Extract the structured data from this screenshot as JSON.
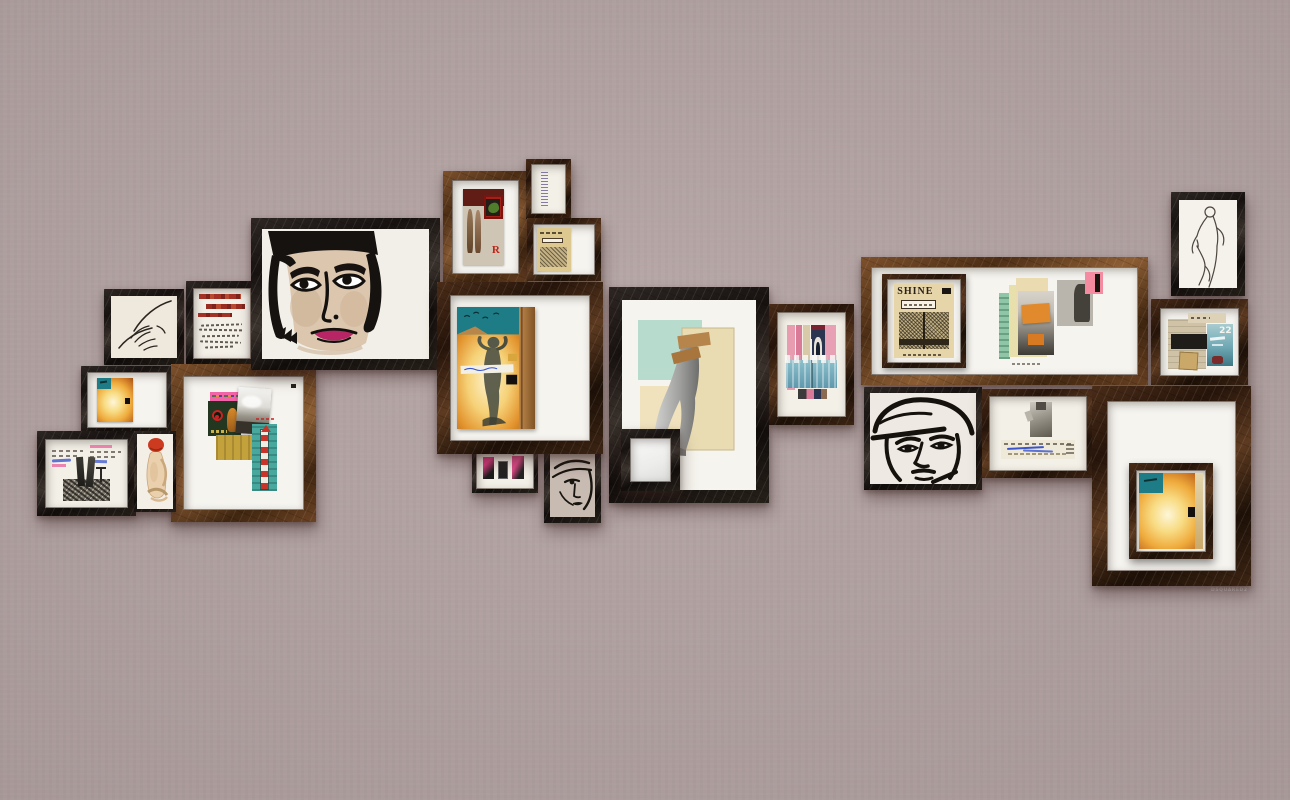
{
  "scene": {
    "type": "gallery-wall-photograph",
    "wall_color": "#b3a2a2",
    "installation": "cluster of vintage framed artworks and collages arranged in a horizontal band"
  },
  "watermark": "DSQUARED2",
  "artwork_texts": {
    "shine_title": "SHINE",
    "number_22": "22",
    "letter_r": "R"
  },
  "palette": {
    "wall": "#b3a2a2",
    "frame_black": "#171210",
    "frame_espresso": "#3c2413",
    "frame_brown": "#6b4223",
    "mat_white": "#f6f4ef",
    "accent_magenta": "#b82565",
    "accent_pink": "#f263a8",
    "accent_teal": "#1d7c85",
    "accent_fire_orange": "#efab3c",
    "accent_mint": "#b7dcce",
    "accent_blue_band": "#7ab4c4"
  },
  "frames": [
    {
      "id": "hand-sketch",
      "description": "ink line drawing of a hand, black distressed frame"
    },
    {
      "id": "red-text-collage",
      "description": "handwriting with red painted strips, black frame"
    },
    {
      "id": "woman-face-portrait",
      "description": "large ink and wash portrait of a woman with black bob and magenta lips"
    },
    {
      "id": "two-figures-collage",
      "description": "sepia collage with two nude figures, pepper picture and red letter R"
    },
    {
      "id": "vertical-card",
      "description": "small card with vertical handwriting strip"
    },
    {
      "id": "mini-sheet-music",
      "description": "small yellowed sheet-music cover collage"
    },
    {
      "id": "fire-paper-small",
      "description": "burned orange paper collage with teal corner on white mat"
    },
    {
      "id": "left-brown-collage",
      "description": "large mixed collage: pink strip, green panel, clouds photo, mustard patch, striped rocket on teal"
    },
    {
      "id": "legs-text-collage",
      "description": "black and white legs photo collage with annotated text snippets"
    },
    {
      "id": "red-hair-figure",
      "description": "watercolor seated nude with red hair"
    },
    {
      "id": "standing-figure-collage",
      "description": "statue figure over fire-toned ground with teal sky and black square"
    },
    {
      "id": "small-pink-photos",
      "description": "three small magenta and black photo scraps"
    },
    {
      "id": "woman-face-sketch-small",
      "description": "small line sketch of a face with headband"
    },
    {
      "id": "legs-collage-large",
      "description": "grayscale legs over mint and cream rectangles with kraft paper scraps"
    },
    {
      "id": "small-mirror",
      "description": "small black frame with blank white panel overlapping the legs frame"
    },
    {
      "id": "pink-blue-collage",
      "description": "pink and blue collage with distressed white lettering band"
    },
    {
      "id": "shine-wide-frame",
      "description": "wide brown frame holding framed SHINE sheet-music cover and a portrait collage with orange patches"
    },
    {
      "id": "aviator-face",
      "description": "bold black-line portrait of an aviator with cap"
    },
    {
      "id": "statue-scribble-collage",
      "description": "statue fragment above scribbled blue-ink text strip"
    },
    {
      "id": "nude-line-sketch",
      "description": "thin pencil outline of a standing nude figure"
    },
    {
      "id": "teal-22-collage",
      "description": "collage with tan papers, black bar and teal sea photo numbered 22"
    },
    {
      "id": "bottom-right-large",
      "description": "large dark distressed frame, white mat, inner framed fire collage"
    }
  ]
}
